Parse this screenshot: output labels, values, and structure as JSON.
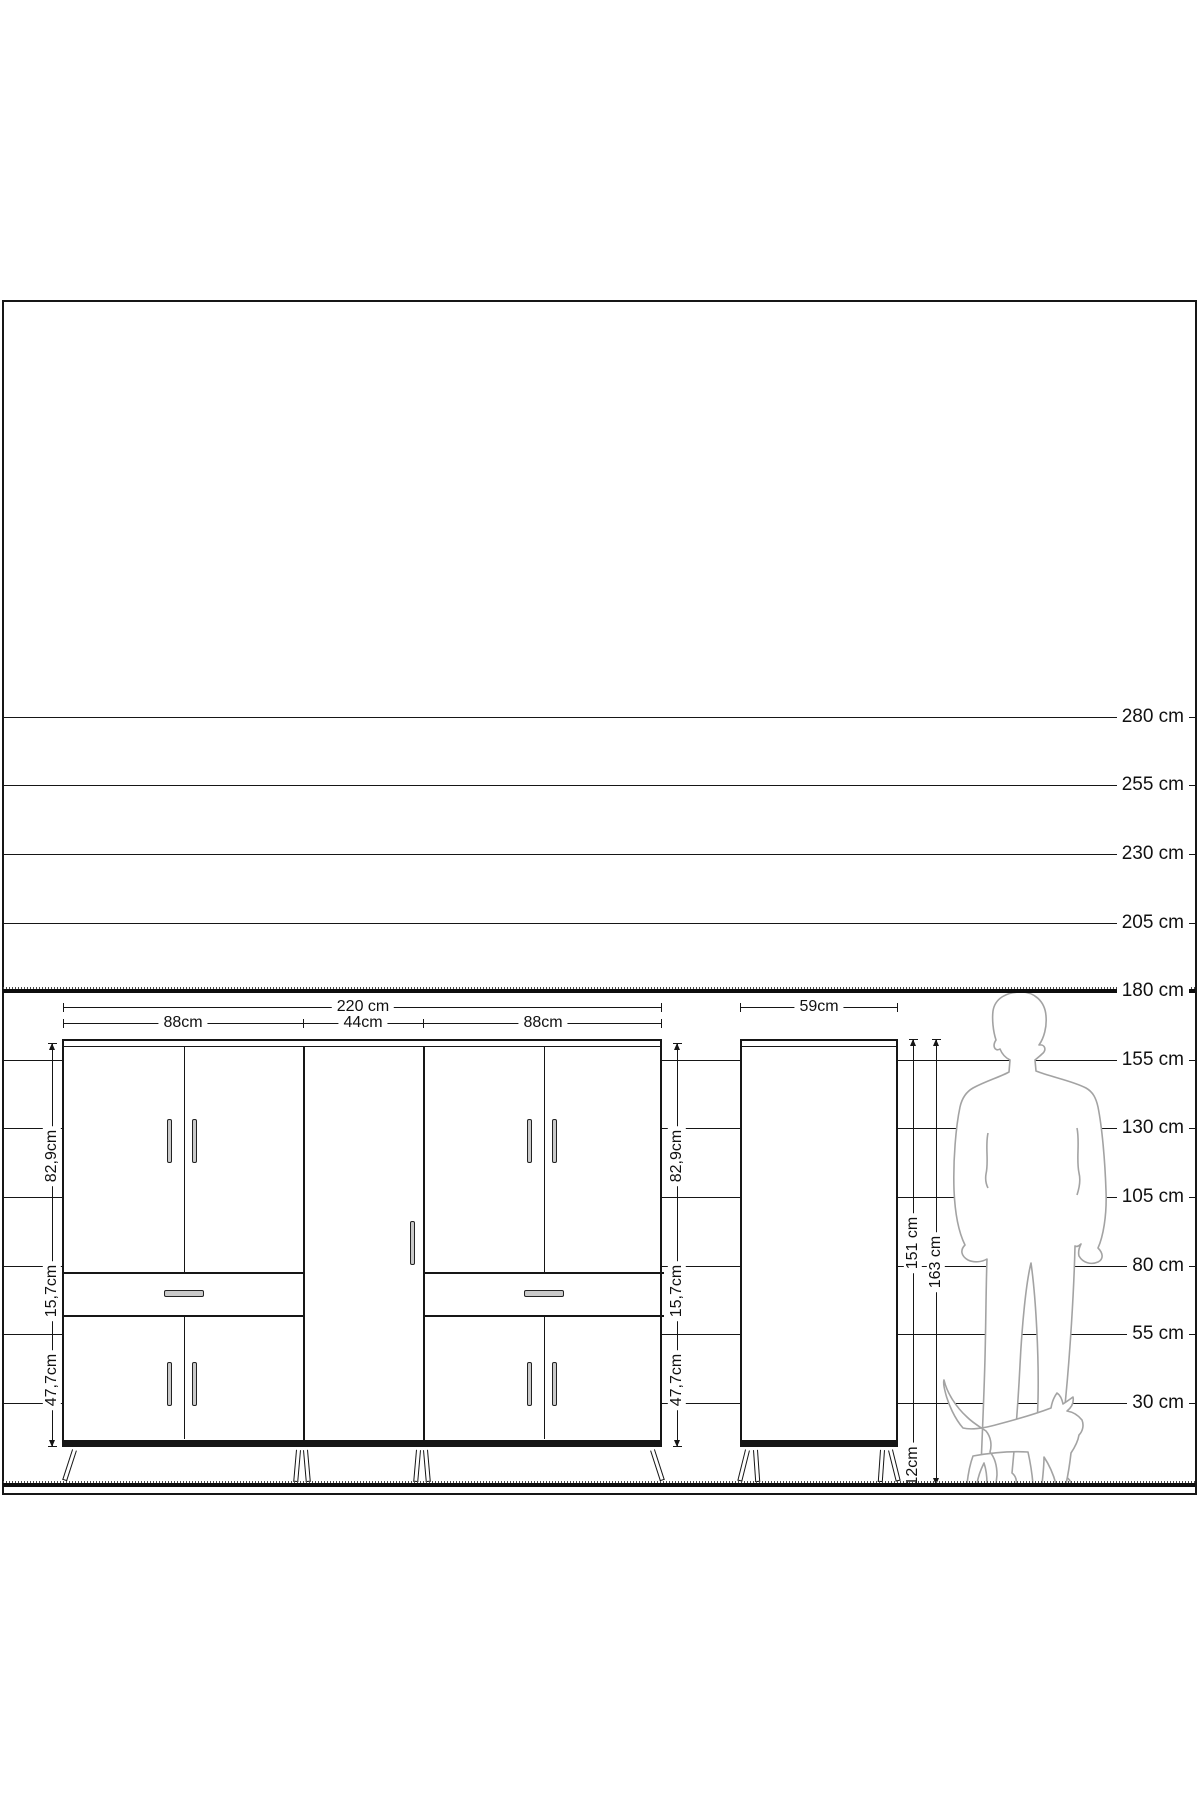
{
  "page": {
    "background": "#ffffff",
    "line_color": "#161616",
    "silhouette_color": "#a3a3a3",
    "handle_color": "#c9c9c9"
  },
  "ruler": {
    "unit": "cm",
    "labels": [
      "280 cm",
      "255 cm",
      "230 cm",
      "205 cm",
      "180 cm",
      "155 cm",
      "130 cm",
      "105 cm",
      "80 cm",
      "55 cm",
      "30 cm"
    ],
    "values_cm": [
      280,
      255,
      230,
      205,
      180,
      155,
      130,
      105,
      80,
      55,
      30
    ],
    "emphasized_label": "180 cm"
  },
  "front_view": {
    "description": "sideboard front elevation with four double-door sections, two drawers and one tall centre door",
    "total_width": "220 cm",
    "section_widths": [
      "88cm",
      "44cm",
      "88cm"
    ],
    "section_heights": [
      "82,9cm",
      "15,7cm",
      "47,7cm"
    ]
  },
  "side_view": {
    "description": "sideboard side elevation",
    "width": "59cm",
    "carcass_height": "151 cm",
    "total_height": "163 cm",
    "leg_height": "12cm"
  },
  "figures": {
    "person": "adult-man-silhouette-180cm",
    "cat": "walking-cat-silhouette"
  }
}
